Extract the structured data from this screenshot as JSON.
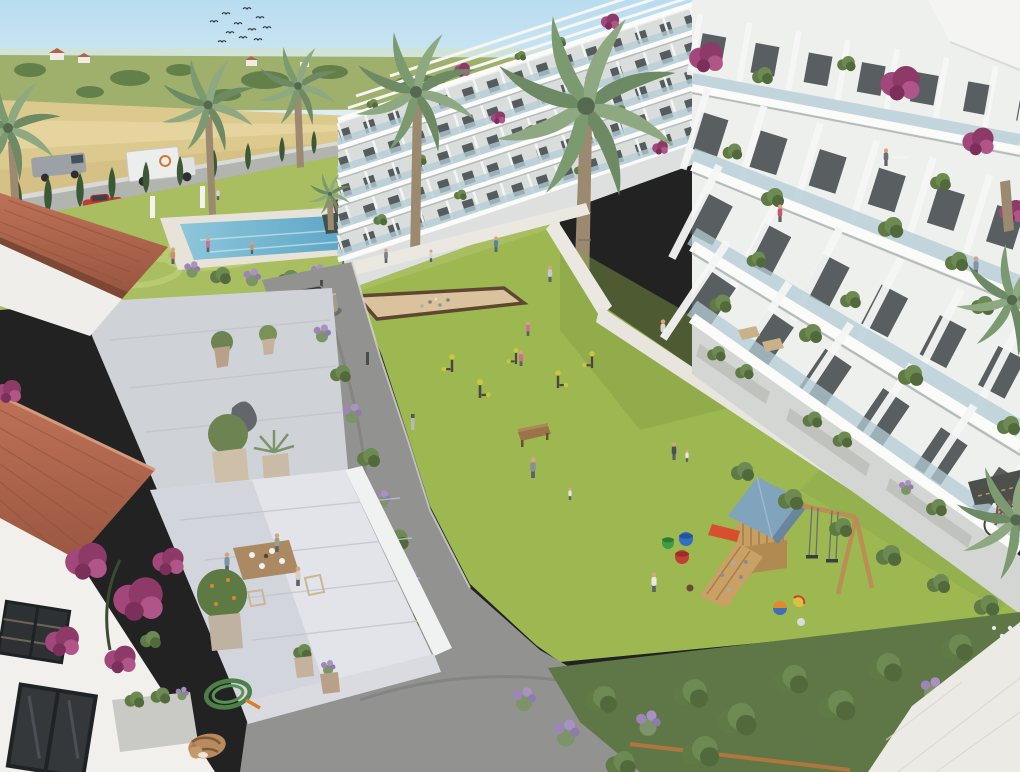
{
  "scene": {
    "kind": "3d-architectural-render",
    "view": "aerial-courtyard",
    "description": "Aerial render of a white residential apartment complex: courtyard lawn with playground and outdoor gym, swimming pool garden, palm trees, tiled-roof house terrace in foreground, golden farm fields behind",
    "regions": {
      "background": [
        "sky",
        "bird-flock",
        "distant-hills",
        "farmhouses",
        "golden-field",
        "country-road",
        "gray-van",
        "white-box-truck",
        "red-car",
        "cypress-hedge",
        "white-boundary-wall"
      ],
      "pool_garden": [
        "ornamental-lawn",
        "mowing-pattern",
        "swimming-pool",
        "pool-deck",
        "pool-planter",
        "swimmers",
        "flower-shrubs",
        "garden-pond"
      ],
      "buildings": [
        "center-apartment-block",
        "right-apartment-block",
        "rooftop-pergolas",
        "glass-balconies",
        "balcony-plants",
        "bougainvillea",
        "residents",
        "ground-terraces",
        "planter-boxes",
        "penthouse-corner"
      ],
      "courtyard": [
        "central-lawn",
        "white-walkways",
        "petanque-court",
        "outdoor-gym",
        "wooden-bench",
        "playground-tower",
        "blue-gable-roof",
        "climbing-ramp",
        "swing-set",
        "red-slide",
        "toy-buckets",
        "play-balls",
        "children",
        "path-bollards"
      ],
      "foreground": [
        "tiled-roof-house",
        "stone-terrace",
        "breakfast-table-scene",
        "potted-citrus-tree",
        "olive-pot",
        "agave-pot",
        "garden-sculpture",
        "lavender-border",
        "bougainvillea-wall",
        "stucco-windows",
        "garden-hose",
        "sleeping-cat",
        "concrete-planter",
        "asphalt-driveway",
        "silver-suv",
        "shrub-border",
        "white-pavement",
        "bicycle",
        "palm-fronds"
      ]
    },
    "counts": {
      "birds": 11,
      "palm_trees": 6,
      "people_approx": 20,
      "gym_machines": 5,
      "apartment_floors_visible": 5
    }
  },
  "palette": {
    "sky_top": "#b8dcf0",
    "sky_low": "#e8f3f4",
    "field": "#dcc98e",
    "lawn": "#9db751",
    "lawn_pool": "#a8be60",
    "pool_light": "#8ec6da",
    "pool_deep": "#58a3c4",
    "building_white": "#eef0ee",
    "asphalt": "#929391",
    "sand": "#d9c29c",
    "play_roof": "#81a4bd",
    "roof_tile": "#bd7257",
    "roof_tile_dark": "#9a5640",
    "bougainvillea": "#a2477b",
    "cypress": "#3c5834",
    "lavender": "#9c86b8"
  }
}
